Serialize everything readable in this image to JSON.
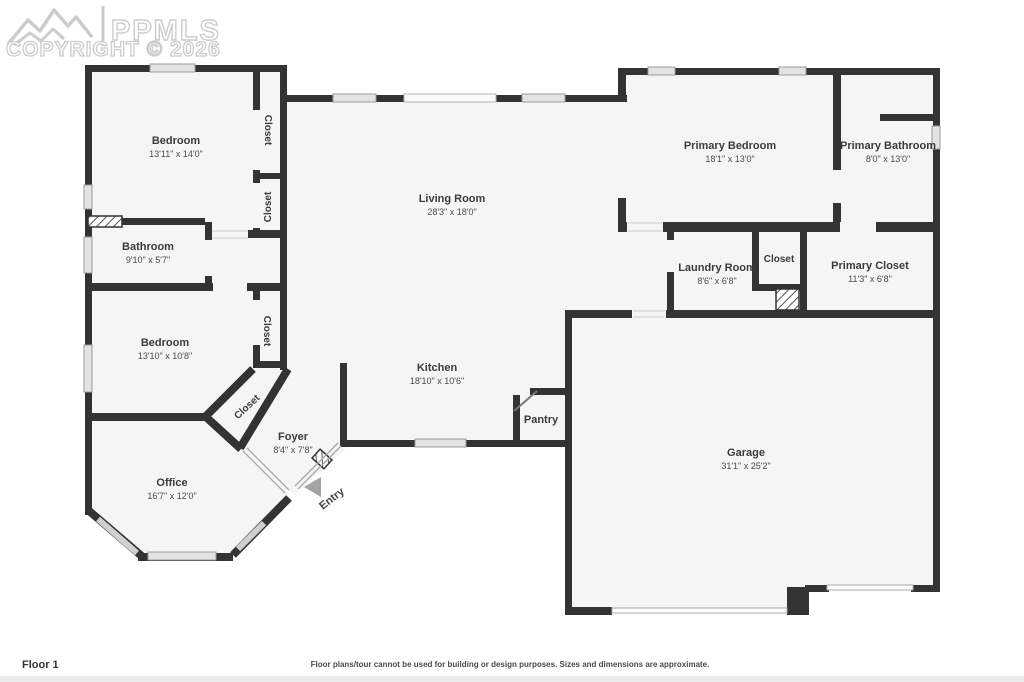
{
  "watermark": {
    "brand": "PPMLS",
    "copyright": "COPYRIGHT © 2026"
  },
  "rooms": [
    {
      "name": "Bedroom",
      "dims": "13'11\" x 14'0\""
    },
    {
      "name": "Closet"
    },
    {
      "name": "Closet"
    },
    {
      "name": "Living Room",
      "dims": "28'3\" x 18'0\""
    },
    {
      "name": "Primary Bedroom",
      "dims": "18'1\" x 13'0\""
    },
    {
      "name": "Primary Bathroom",
      "dims": "8'0\" x 13'0\""
    },
    {
      "name": "Bathroom",
      "dims": "9'10\" x 5'7\""
    },
    {
      "name": "Laundry Room",
      "dims": "8'6\" x 6'8\""
    },
    {
      "name": "Closet"
    },
    {
      "name": "Primary Closet",
      "dims": "11'3\" x 6'8\""
    },
    {
      "name": "Bedroom",
      "dims": "13'10\" x 10'8\""
    },
    {
      "name": "Closet"
    },
    {
      "name": "Closet"
    },
    {
      "name": "Kitchen",
      "dims": "18'10\" x 10'6\""
    },
    {
      "name": "Pantry"
    },
    {
      "name": "Foyer",
      "dims": "8'4\" x 7'8\""
    },
    {
      "name": "Office",
      "dims": "16'7\" x 12'0\""
    },
    {
      "name": "Entry"
    },
    {
      "name": "Garage",
      "dims": "31'1\" x 25'2\""
    }
  ],
  "footer": {
    "floor_label": "Floor 1",
    "disclaimer": "Floor plans/tour cannot be used for building or design purposes. Sizes and dimensions are approximate."
  },
  "colors": {
    "wall": "#333333",
    "floor": "#f5f5f5",
    "window": "#e3e3e3",
    "text": "#3b3b3b",
    "watermark": "#cccccc"
  }
}
